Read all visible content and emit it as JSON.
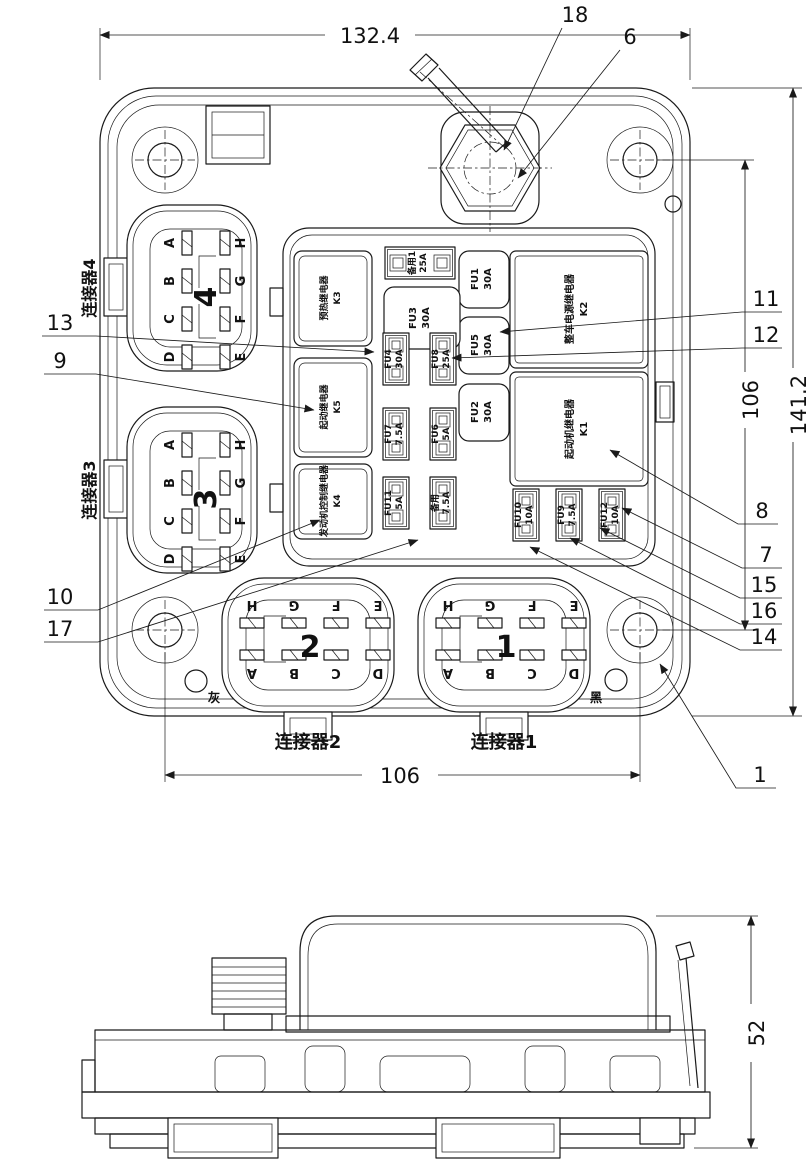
{
  "drawing": {
    "dims": {
      "top": "132.4",
      "pitch_v": "106",
      "overall_h": "141.2",
      "pitch_h": "106",
      "side_h": "52"
    },
    "callouts": {
      "n1": "1",
      "n6": "6",
      "n7": "7",
      "n8": "8",
      "n9": "9",
      "n10": "10",
      "n11": "11",
      "n12": "12",
      "n13": "13",
      "n14": "14",
      "n15": "15",
      "n16": "16",
      "n17": "17",
      "n18": "18"
    },
    "connectors": {
      "c4": {
        "label": "连接器4",
        "num": "4",
        "pins_left": [
          "A",
          "B",
          "C",
          "D"
        ],
        "pins_right": [
          "H",
          "G",
          "F",
          "E"
        ]
      },
      "c3": {
        "label": "连接器3",
        "num": "3",
        "pins_left": [
          "A",
          "B",
          "C",
          "D"
        ],
        "pins_right": [
          "H",
          "G",
          "F",
          "E"
        ]
      },
      "c2": {
        "label": "连接器2",
        "num": "2",
        "pins_top": [
          "H",
          "G",
          "F",
          "E"
        ],
        "pins_bottom": [
          "A",
          "B",
          "C",
          "D"
        ],
        "mark": "灰"
      },
      "c1": {
        "label": "连接器1",
        "num": "1",
        "pins_top": [
          "H",
          "G",
          "F",
          "E"
        ],
        "pins_bottom": [
          "A",
          "B",
          "C",
          "D"
        ],
        "mark": "黑"
      }
    },
    "relays": {
      "k3": {
        "id": "K3",
        "name": "预热继电器"
      },
      "k5": {
        "id": "K5",
        "name": "起动继电器"
      },
      "k4": {
        "id": "K4",
        "name": "发动机控制继电器"
      },
      "k2": {
        "id": "K2",
        "name": "整车电源继电器"
      },
      "k1": {
        "id": "K1",
        "name": "起动机继电器"
      }
    },
    "fuses": {
      "spare_top": {
        "id": "备用1",
        "rating": "25A"
      },
      "fu3": {
        "id": "FU3",
        "rating": "30A"
      },
      "fu1": {
        "id": "FU1",
        "rating": "30A"
      },
      "fu5": {
        "id": "FU5",
        "rating": "30A"
      },
      "fu2": {
        "id": "FU2",
        "rating": "30A"
      },
      "fu4": {
        "id": "FU4",
        "rating": "30A"
      },
      "fu8": {
        "id": "FU8",
        "rating": "25A"
      },
      "fu7": {
        "id": "FU7",
        "rating": "7.5A"
      },
      "fu6": {
        "id": "FU6",
        "rating": "5A"
      },
      "fu11": {
        "id": "FU11",
        "rating": "5A"
      },
      "spare_mid": {
        "id": "备用",
        "rating": "7.5A"
      },
      "fu10": {
        "id": "FU10",
        "rating": "10A"
      },
      "fu9": {
        "id": "FU9",
        "rating": "7.5A"
      },
      "fu12": {
        "id": "FU12",
        "rating": "10A"
      }
    }
  }
}
